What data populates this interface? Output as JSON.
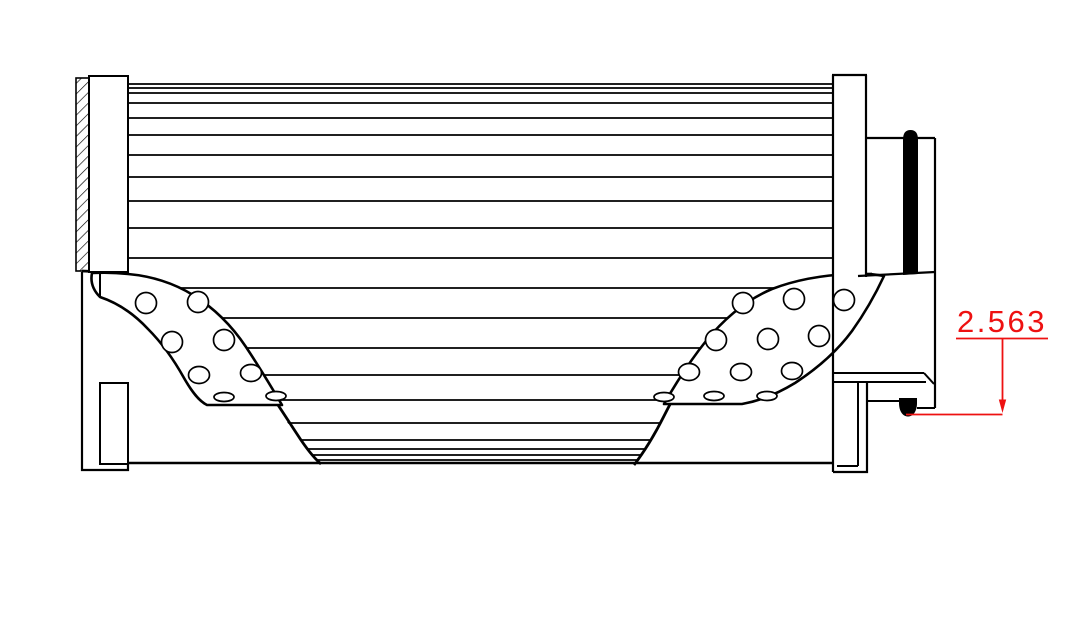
{
  "drawing": {
    "type": "technical-cross-section",
    "description_parts": [
      "hatched-end-plate",
      "end-caps",
      "pleated-media-lines",
      "perforated-core-bands",
      "seal-bar",
      "o-ring"
    ],
    "colors": {
      "line": "#000000",
      "background": "#ffffff",
      "dimension": "#ee1111",
      "seal_fill": "#000000"
    }
  },
  "dimension": {
    "value": "2.563",
    "style": "underlined-leader-with-down-arrow"
  }
}
